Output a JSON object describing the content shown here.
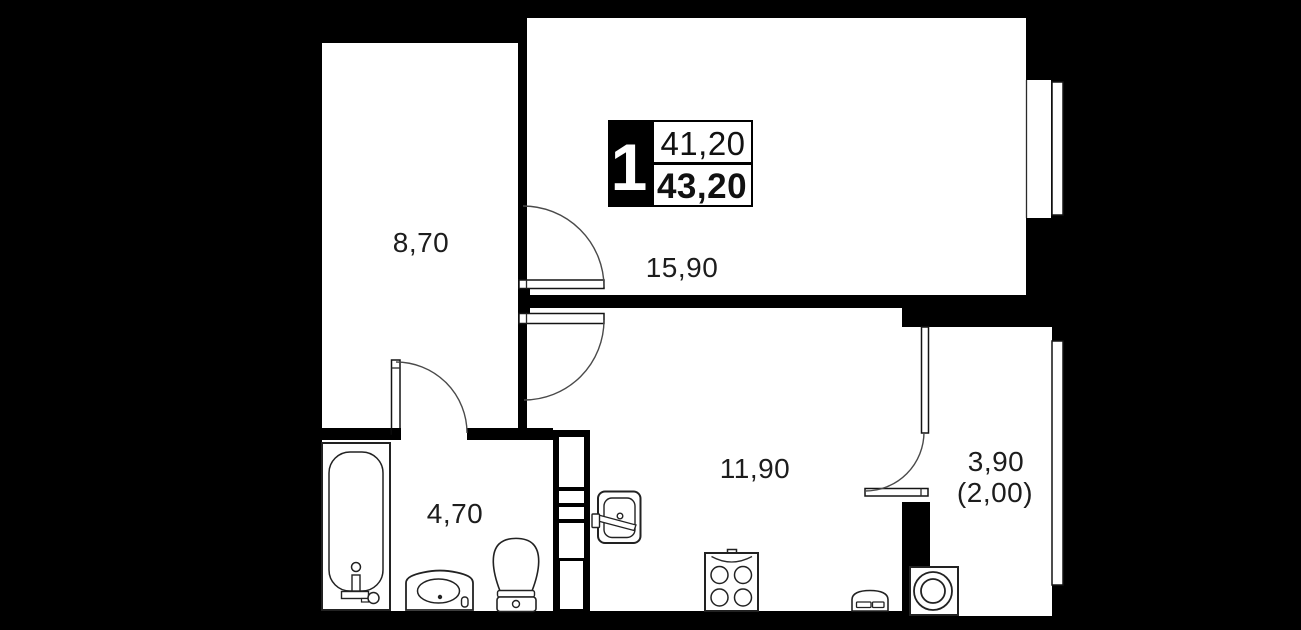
{
  "plan": {
    "type": "apartment-floor-plan",
    "background_color": "#000000",
    "floor_color": "#ffffff",
    "wall_color": "#000000",
    "line_color": "#222222"
  },
  "badge": {
    "rooms_count": "1",
    "area_top": "41,20",
    "area_bottom": "43,20"
  },
  "rooms": {
    "hallway": {
      "label": "8,70"
    },
    "living": {
      "label": "15,90"
    },
    "kitchen": {
      "label": "11,90"
    },
    "bathroom": {
      "label": "4,70"
    },
    "balcony": {
      "label": "3,90",
      "label_secondary": "(2,00)"
    }
  },
  "fixtures": [
    "bathtub-icon",
    "vanity-sink-icon",
    "toilet-icon",
    "kitchen-sink-icon",
    "stove-icon",
    "radiator-icon",
    "washing-machine-icon",
    "window-icon",
    "door-arc-icon",
    "vent-shaft-icon"
  ]
}
